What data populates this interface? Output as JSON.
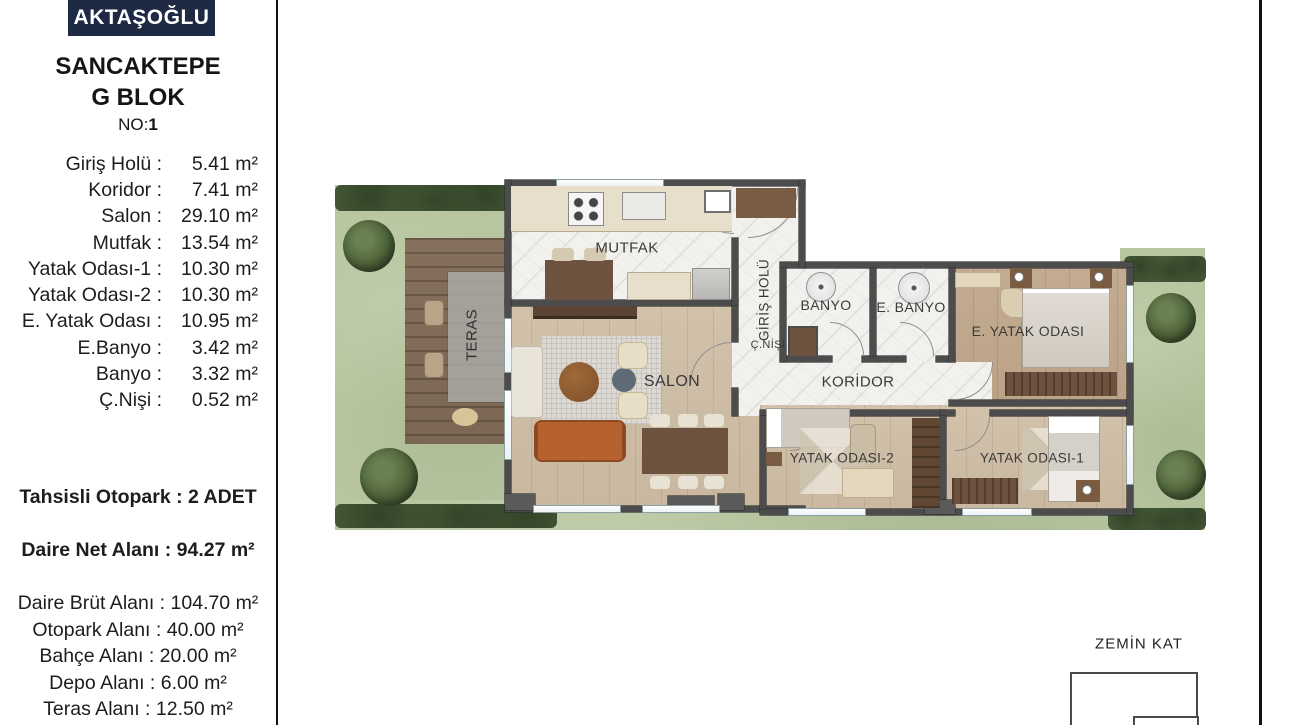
{
  "sidebar": {
    "logo": "AKTAŞOĞLU",
    "project": "SANCAKTEPE",
    "block": "G BLOK",
    "no_label": "NO:",
    "no_value": "1",
    "rooms": [
      {
        "label": "Giriş Holü :",
        "value": "5.41 m²"
      },
      {
        "label": "Koridor :",
        "value": "7.41 m²"
      },
      {
        "label": "Salon :",
        "value": "29.10 m²"
      },
      {
        "label": "Mutfak :",
        "value": "13.54 m²"
      },
      {
        "label": "Yatak Odası-1 :",
        "value": "10.30 m²"
      },
      {
        "label": "Yatak Odası-2 :",
        "value": "10.30 m²"
      },
      {
        "label": "E. Yatak Odası :",
        "value": "10.95 m²"
      },
      {
        "label": "E.Banyo :",
        "value": "3.42 m²"
      },
      {
        "label": "Banyo :",
        "value": "3.32 m²"
      },
      {
        "label": "Ç.Nişi :",
        "value": "0.52 m²"
      }
    ],
    "parking": "Tahsisli Otopark : 2 ADET",
    "net_area": "Daire Net Alanı : 94.27 m²",
    "extra": [
      "Daire Brüt Alanı : 104.70 m²",
      "Otopark Alanı : 40.00 m²",
      "Bahçe Alanı : 20.00 m²",
      "Depo Alanı : 6.00 m²",
      "Teras Alanı : 12.50 m²"
    ]
  },
  "plan": {
    "labels": {
      "mutfak": "MUTFAK",
      "teras": "TERAS",
      "salon": "SALON",
      "giris": "GİRİŞ HOLÜ",
      "banyo": "BANYO",
      "ebanyo": "E. BANYO",
      "eyatak": "E. YATAK ODASI",
      "cnisi": "Ç.NİŞİ",
      "koridor": "KORİDOR",
      "yatak2": "YATAK ODASI-2",
      "yatak1": "YATAK ODASI-1"
    },
    "floor_label": "ZEMİN KAT"
  },
  "colors": {
    "brand_navy": "#1e2944",
    "wall_gray": "#4c4c4c",
    "lawn_green": "#b7c6a0",
    "hedge_green": "#4a5c3c",
    "deck_brown": "#7f6b57",
    "wood_floor": "#cdbca5",
    "marble_floor": "#f3f1ee",
    "sofa_orange": "#b5622f"
  }
}
